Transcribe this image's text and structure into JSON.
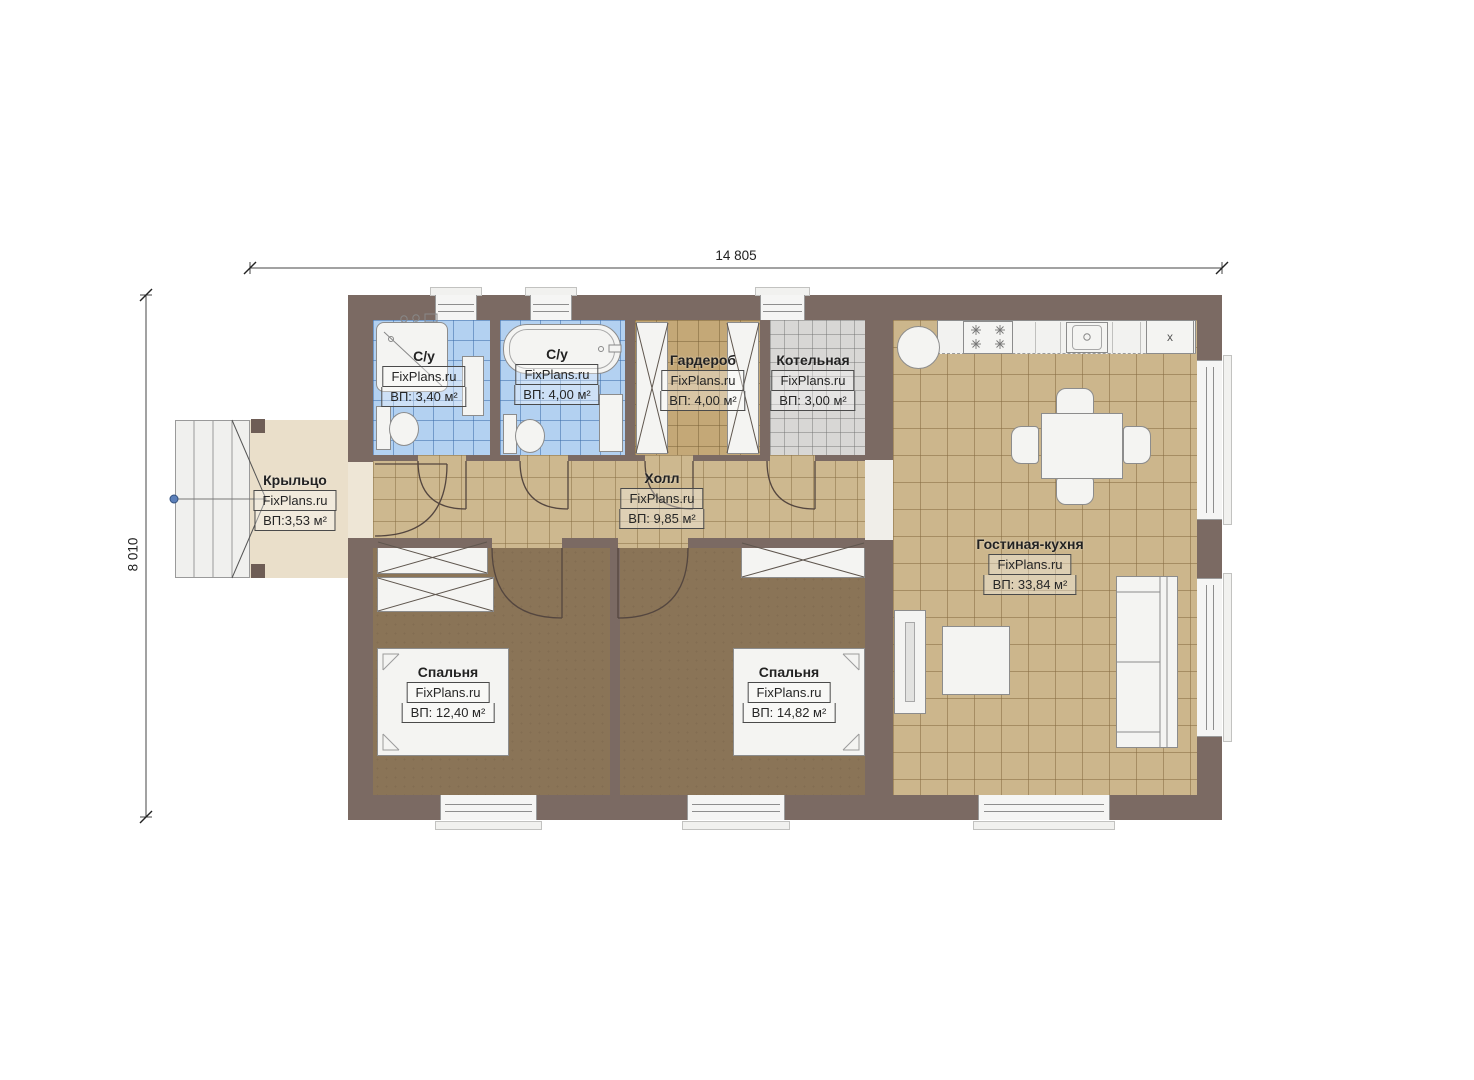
{
  "watermark": "FixPlans.ru",
  "dimensions": {
    "width": "14 805",
    "height": "8 010"
  },
  "rooms": {
    "bath1": {
      "name": "С/у",
      "area": "ВП: 3,40 м²"
    },
    "bath2": {
      "name": "С/у",
      "area": "ВП: 4,00 м²"
    },
    "wardrobe": {
      "name": "Гардероб",
      "area": "ВП: 4,00 м²"
    },
    "boiler": {
      "name": "Котельная",
      "area": "ВП: 3,00 м²"
    },
    "hall": {
      "name": "Холл",
      "area": "ВП: 9,85 м²"
    },
    "porch": {
      "name": "Крыльцо",
      "area": "ВП:3,53 м²"
    },
    "bedroom1": {
      "name": "Спальня",
      "area": "ВП: 12,40 м²"
    },
    "bedroom2": {
      "name": "Спальня",
      "area": "ВП: 14,82 м²"
    },
    "living": {
      "name": "Гостиная-кухня",
      "area": "ВП: 33,84 м²"
    }
  },
  "kitchen": {
    "fridge_label": "x"
  },
  "colors": {
    "wall": "#7b6a63",
    "tile_tan": "#ccb68c",
    "tile_blue": "#b3d1f1",
    "tile_gray": "#d8d7d5",
    "bedroom_floor": "#8a7457",
    "porch": "#eadfca"
  }
}
